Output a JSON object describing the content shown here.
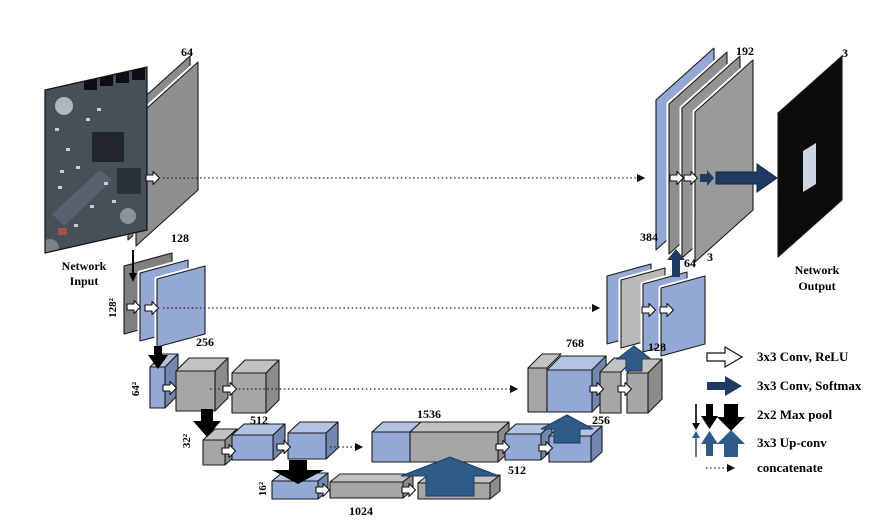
{
  "figure": {
    "input": {
      "line1": "Network",
      "line2": "Input"
    },
    "output": {
      "line1": "Network",
      "line2": "Output",
      "channels": "3"
    },
    "encoder": {
      "level1": "64",
      "level2": "128",
      "level3": "256",
      "level4": "512",
      "bottleneck": "1024",
      "res1": "128²",
      "res2": "64²",
      "res3": "32²",
      "res4": "16²"
    },
    "decoder": {
      "concat4": "1536",
      "conv4": "512",
      "up3": "256",
      "concat3": "768",
      "up2": "128",
      "concat2": "384",
      "up1": "64",
      "preout": "3",
      "level1": "192"
    },
    "legend": {
      "conv_relu": "3x3 Conv, ReLU",
      "conv_softmax": "3x3 Conv, Softmax",
      "maxpool": "2x2 Max pool",
      "upconv": "3x3 Up-conv",
      "concatenate": "concatenate"
    },
    "colors": {
      "feature_blue": "#93a8d4",
      "feature_blue_top": "#b4c3e3",
      "feature_blue_side": "#7187b0",
      "feature_gray": "#a6a6a6",
      "feature_gray_dark": "#8a8a8a",
      "navy": "#1f3a63",
      "steel_blue": "#2e5c86"
    }
  }
}
